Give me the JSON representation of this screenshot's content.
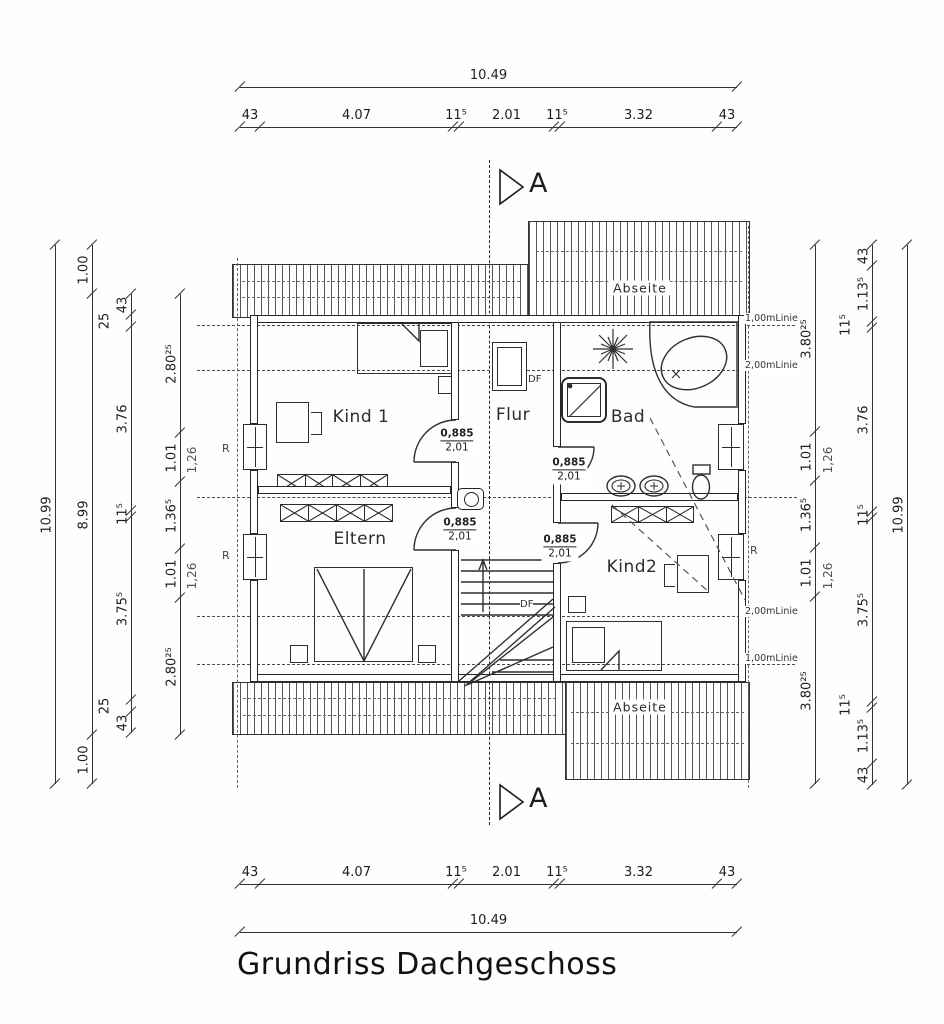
{
  "title": "Grundriss Dachgeschoss",
  "section_marker": "A",
  "rooms": {
    "kind1": "Kind 1",
    "flur": "Flur",
    "bad": "Bad",
    "eltern": "Eltern",
    "kind2": "Kind2"
  },
  "abseite": "Abseite",
  "skylight": "DF",
  "downpipe": "R",
  "height_lines": {
    "one_meter": "1,00mLinie",
    "two_meter": "2,00mLinie"
  },
  "door": {
    "width": "0,885",
    "height": "2,01"
  },
  "dims": {
    "top_overall": [
      "10.49"
    ],
    "top_segments": [
      "43",
      "4.07",
      "11⁵",
      "2.01",
      "11⁵",
      "3.32",
      "43"
    ],
    "bottom_segments": [
      "43",
      "4.07",
      "11⁵",
      "2.01",
      "11⁵",
      "3.32",
      "43"
    ],
    "bottom_overall": [
      "10.49"
    ],
    "left_outer": [
      "10.99"
    ],
    "left_mid": [
      "1.00",
      "8.99",
      "1.00"
    ],
    "left_knee": [
      "43",
      "25",
      "3.76",
      "11⁵",
      "3.75⁵",
      "25",
      "43"
    ],
    "left_inner": [
      "2.80²⁵",
      "1.01",
      "1.36⁵",
      "1.01",
      "2.80²⁵"
    ],
    "right_inner": [
      "3.80²⁵",
      "1.01",
      "1.36⁵",
      "1.01",
      "3.80²⁵"
    ],
    "right_mid": [
      "43",
      "1.13⁵",
      "11⁵",
      "3.76",
      "11⁵",
      "3.75⁵",
      "11⁵",
      "1.13⁵",
      "43"
    ],
    "right_outer": [
      "10.99"
    ],
    "companion": "1,26"
  }
}
